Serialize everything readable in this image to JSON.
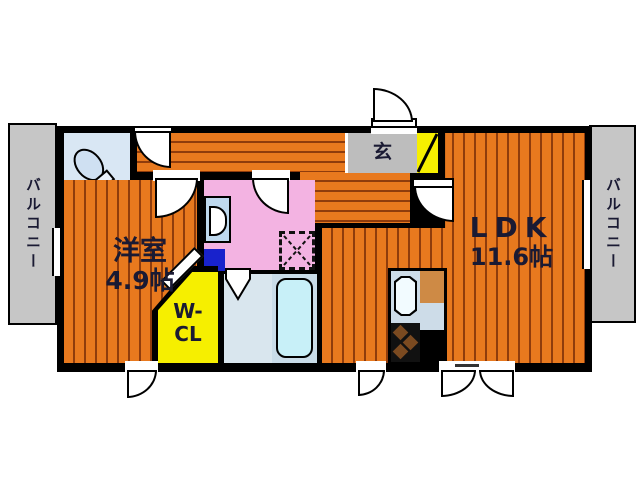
{
  "floor_plan": {
    "balconies": {
      "left": "バルコニー",
      "right": "バルコニー"
    },
    "entrance_label": "玄",
    "rooms": {
      "western_room": {
        "name": "洋室",
        "size": "4.9帖"
      },
      "walk_in_closet": {
        "name_line1": "W-",
        "name_line2": "CL"
      },
      "ldk": {
        "name": "LDK",
        "size": "11.6帖"
      }
    },
    "colors": {
      "floor_orange": "#e8791e",
      "floor_stripe": "#8f3c0c",
      "wall_black": "#000000",
      "washroom_pink": "#f3b3e2",
      "closet_yellow": "#f6ef00",
      "balcony_gray": "#c6c6c6",
      "entrance_gray": "#bdbdbd",
      "sanitary_blue": "#d9e7f4",
      "bathtub_cyan": "#c8f0f8",
      "accent_blue": "#1822cc",
      "counter_tan": "#ce8a45",
      "text_navy": "#1a1a33"
    }
  }
}
